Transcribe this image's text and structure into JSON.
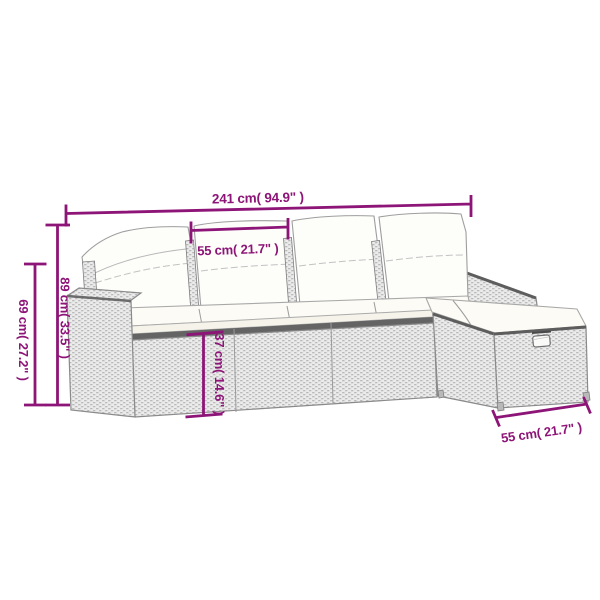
{
  "diagram": {
    "kind": "product-dimension-diagram",
    "subject": "poly-rattan-garden-lounge-set-line-drawing",
    "accent_color": "#8d1577",
    "artwork_colors": {
      "outline_gray": "#8a8a8a",
      "wicker_fill": "#ececec",
      "cushion_fill": "#fdfdfa",
      "rim_dark": "#5d5d5d"
    },
    "labels": {
      "overall_width": "241 cm( 94.9\" )",
      "seat_width": "55 cm( 21.7\" )",
      "back_height": "89 cm( 33.5\" )",
      "arm_height": "69 cm( 27.2\" )",
      "seat_height": "37 cm( 14.6\" )",
      "footstool_width": "55 cm( 21.7\" )"
    }
  }
}
